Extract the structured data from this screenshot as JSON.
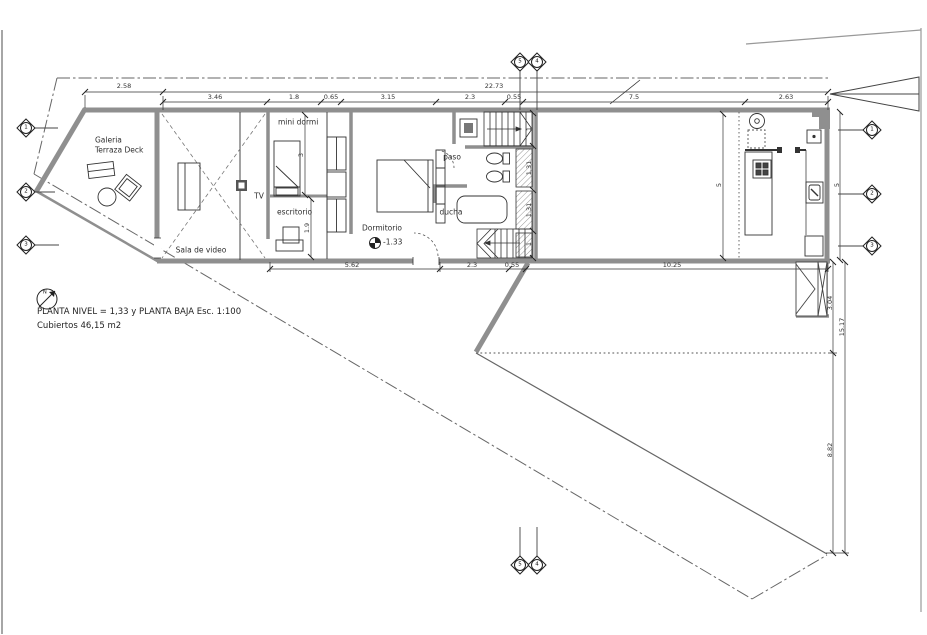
{
  "drawing": {
    "title": "PLANTA NIVEL = 1,33 y PLANTA BAJA  Esc. 1:100",
    "area_note": "Cubiertos 46,15 m2",
    "north_label": "N"
  },
  "rooms": {
    "galeria_line1": "Galeria",
    "galeria_line2": "Terraza Deck",
    "sala": "Sala de video",
    "tv": "TV",
    "mini_dormi": "mini dormi",
    "escritorio": "escritorio",
    "dormitorio": "Dormitorio",
    "level": "-1.33",
    "paso": "paso",
    "ducha": "ducha"
  },
  "dims": {
    "top_row1": [
      "2.58",
      "22.73"
    ],
    "top_row2": [
      "3.46",
      "1.8",
      "0.65",
      "3.15",
      "2.3",
      "0.55",
      "7.5",
      "2.63"
    ],
    "bottom": [
      "5.62",
      "2.3",
      "0.55",
      "10.25"
    ],
    "interior_left": [
      "3",
      "1.9"
    ],
    "bath": [
      "1",
      "1.31",
      "1.31",
      "1"
    ],
    "kitchen": [
      "5",
      "5"
    ],
    "right": [
      "3.04",
      "15.17",
      "8.82"
    ]
  },
  "grid": {
    "left": [
      "1",
      "2",
      "3"
    ],
    "right": [
      "1",
      "2",
      "3"
    ],
    "top": [
      "5",
      "4"
    ],
    "bottom": [
      "5",
      "4"
    ]
  }
}
